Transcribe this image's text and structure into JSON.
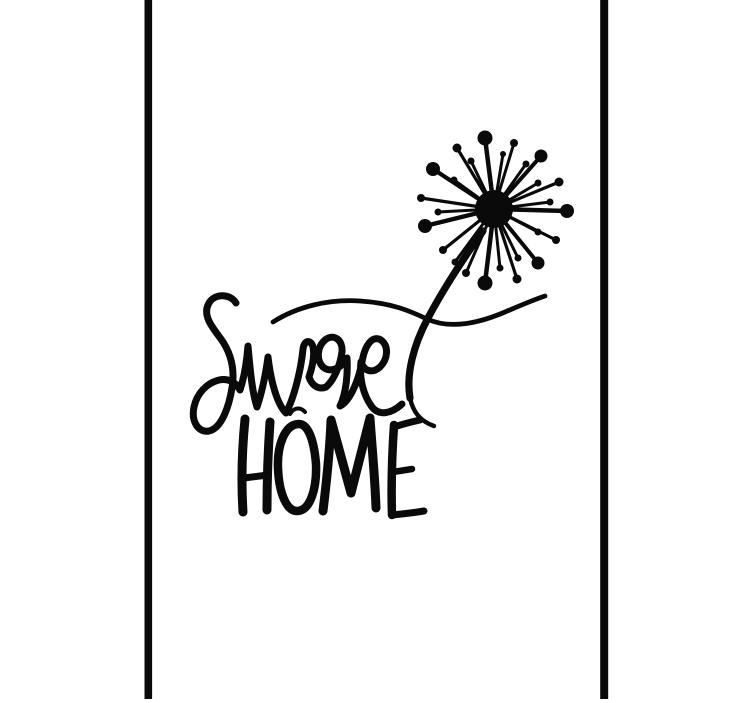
{
  "artwork": {
    "word_script": "sweet",
    "word_caps": "HOME",
    "colors": {
      "ink": "#0a0a0a",
      "background": "#ffffff"
    },
    "icons": {
      "flower": "dandelion-flower-icon"
    }
  }
}
